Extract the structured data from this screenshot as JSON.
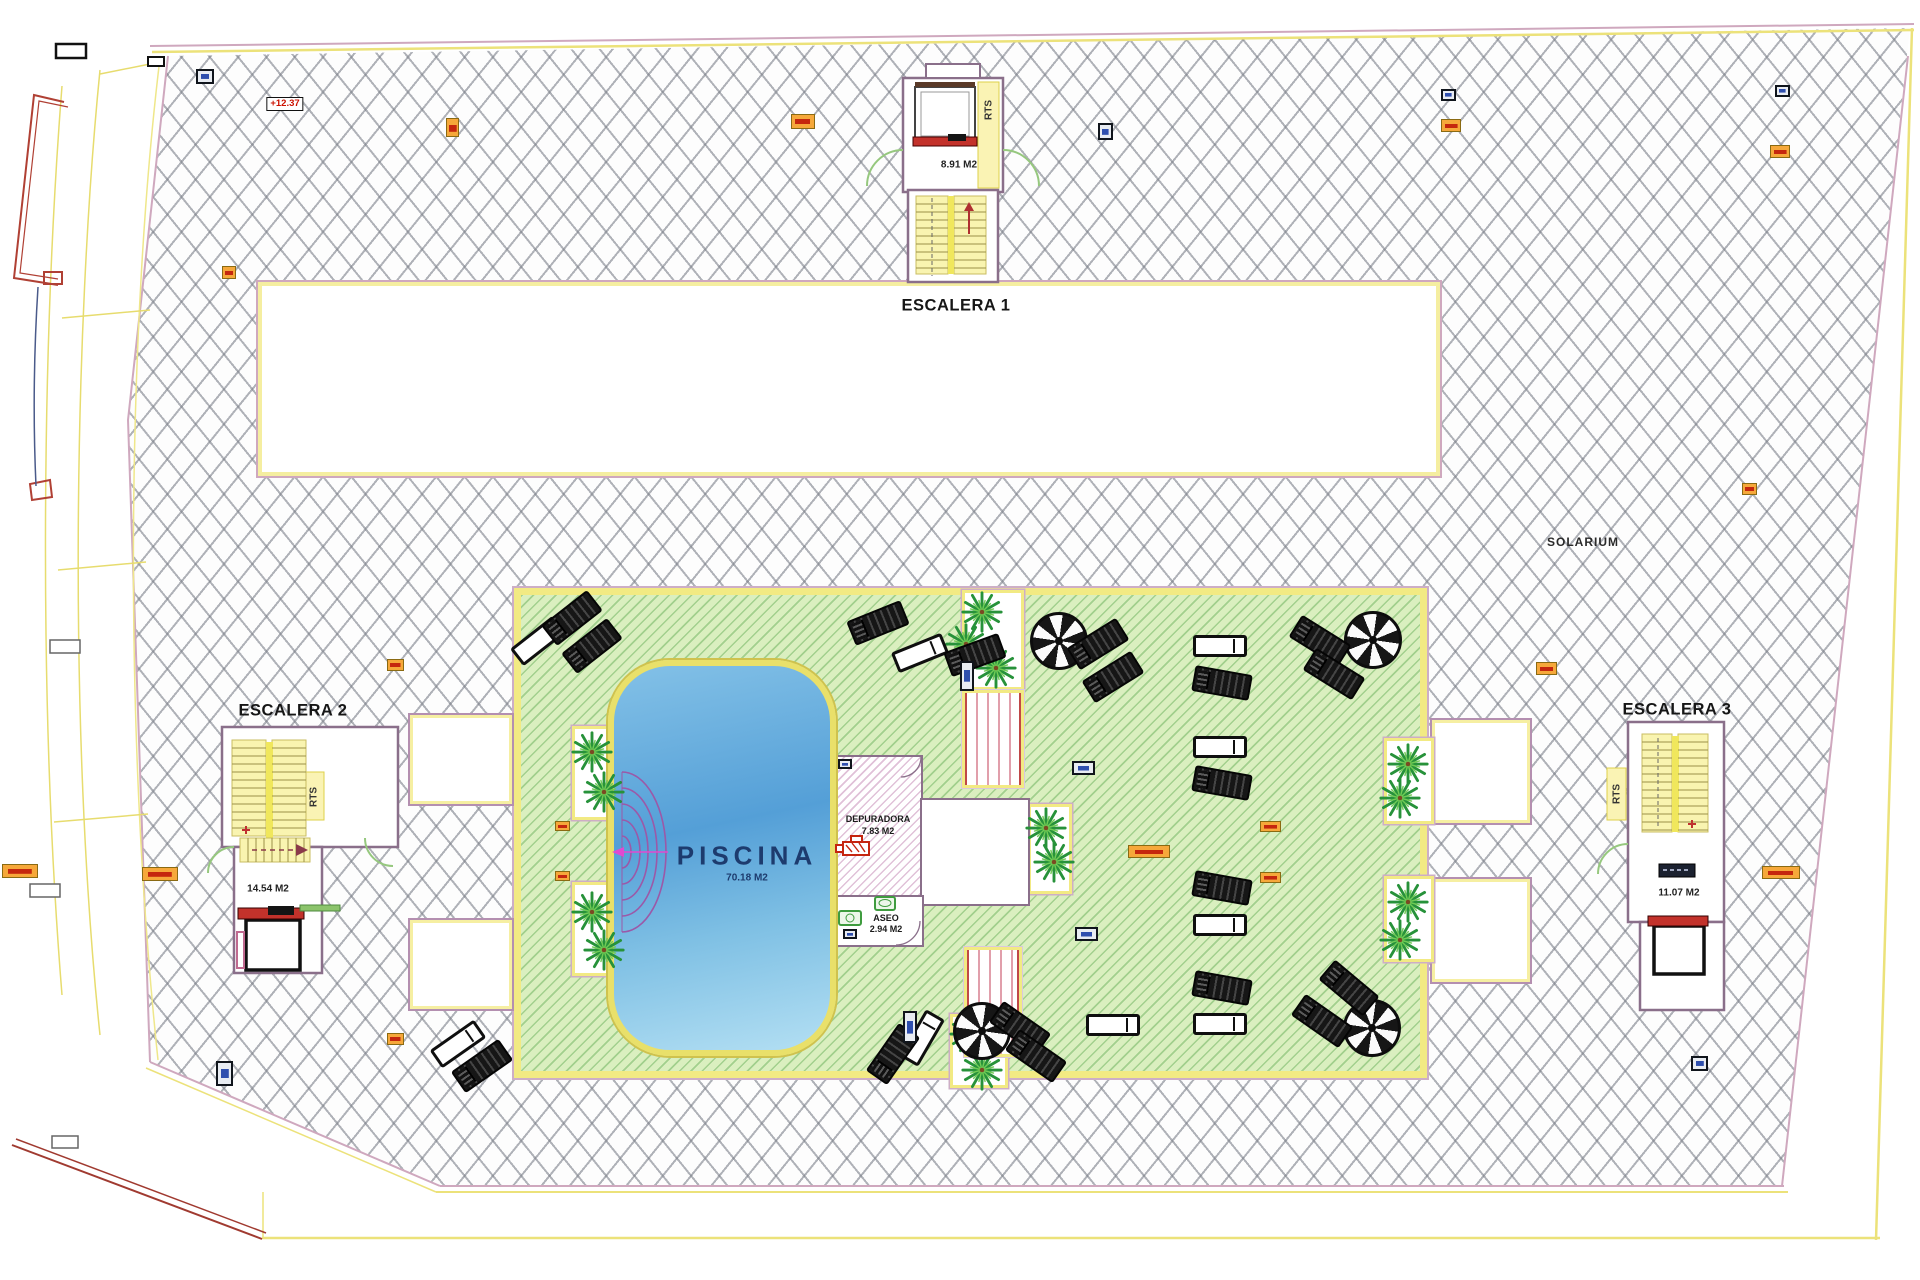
{
  "labels": {
    "escalera1": "ESCALERA 1",
    "escalera2": "ESCALERA 2",
    "escalera3": "ESCALERA 3",
    "solarium": "SOLARIUM"
  },
  "pool": {
    "name": "PISCINA",
    "area": "70.18 M2"
  },
  "rooms": {
    "depuradora": {
      "name": "DEPURADORA",
      "area": "7.83 M2"
    },
    "aseo": {
      "name": "ASEO",
      "area": "2.94 M2"
    },
    "stair1_area": "8.91 M2",
    "stair2_area": "14.54 M2",
    "stair3_area": "11.07 M2",
    "rts": "RTS"
  },
  "annotations": {
    "level_mark": "+12.37"
  },
  "colors": {
    "deck_green": "#daefbf",
    "pool_blue": "#549fd7",
    "border_yellow": "#f2ea83",
    "wall_pink": "#8a6f8a",
    "marker_orange": "#f6a83a",
    "marker_red": "#c5270e",
    "stair_yellow": "#f9f4b0",
    "red_accent": "#c3322b"
  }
}
